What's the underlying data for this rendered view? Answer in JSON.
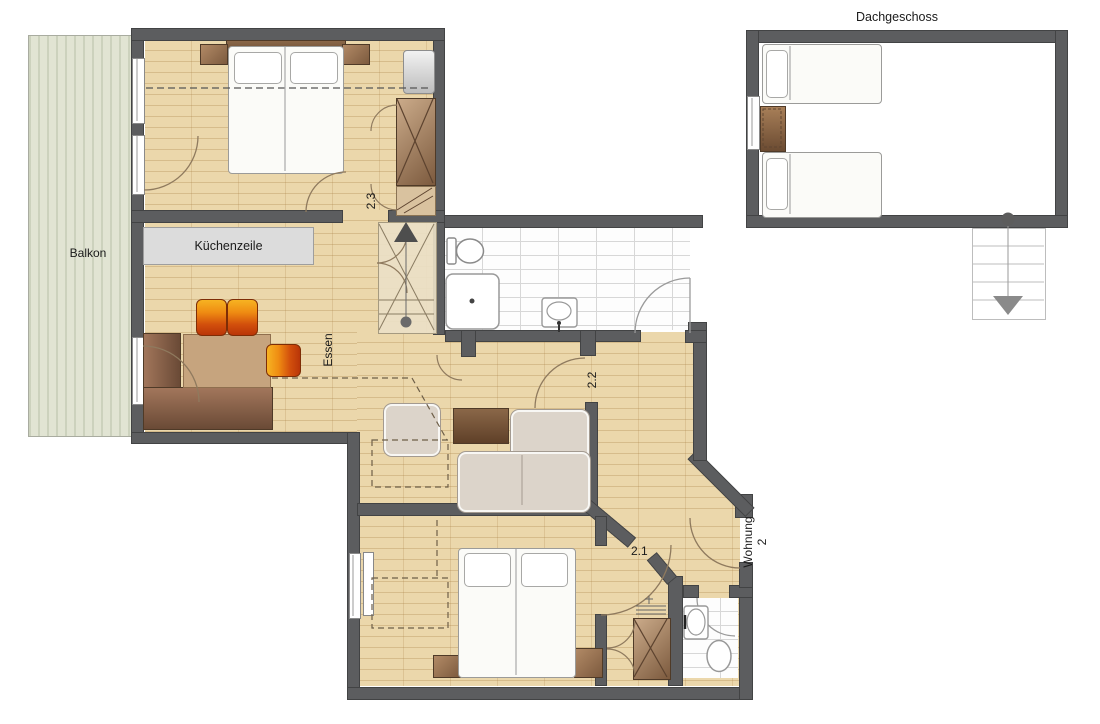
{
  "plan": {
    "attic_label": "Dachgeschoss",
    "balcony_label": "Balkon",
    "kitchen_label": "Küchenzeile",
    "dining_label": "Essen",
    "rooms": {
      "bedroom_top": "2.3",
      "hall": "2.2",
      "bedroom_bottom": "2.1"
    },
    "entry": {
      "line1": "Wohnung",
      "line2": "2"
    },
    "colors": {
      "wall": "#5c5d5f",
      "wood_floor": "#ebd7ab",
      "tile_floor": "#fdfdfd",
      "balcony_floor": "#e1e4d3",
      "furniture_wood": "#7c5a3e",
      "stool_orange": "#d24f0c",
      "counter_gray": "#dcdcdc"
    }
  }
}
